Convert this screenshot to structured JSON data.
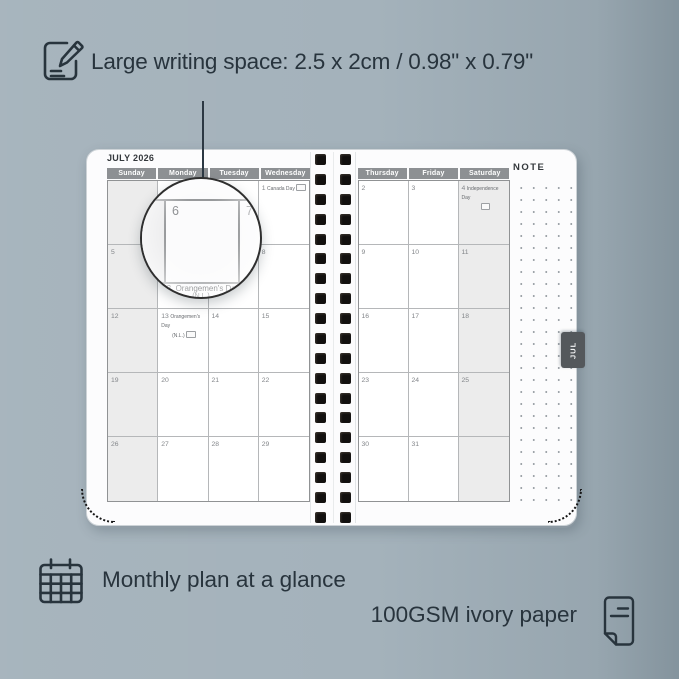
{
  "colors": {
    "background": "#a4b2bb",
    "ink": "#28343d",
    "page_white": "#fcfcfd",
    "header_gray": "#8d9093",
    "weekend_gray": "#ececec",
    "tab_gray": "#54585c",
    "spiral_black": "#12100f"
  },
  "annotations": {
    "writing_space": {
      "icon": "pencil-note-icon",
      "text": "Large writing space: 2.5 x 2cm / 0.98\" x 0.79\""
    },
    "monthly_plan": {
      "icon": "calendar-grid-icon",
      "text": "Monthly plan at a glance"
    },
    "paper": {
      "icon": "paper-sheet-icon",
      "text": "100GSM ivory paper"
    }
  },
  "planner": {
    "month_title": "JULY 2026",
    "note_label": "NOTE",
    "month_tab": "JUL",
    "left_page": {
      "day_headers": [
        "Sunday",
        "Monday",
        "Tuesday",
        "Wednesday"
      ],
      "weeks": [
        [
          {},
          {},
          {},
          {
            "day": "1",
            "holiday": "Canada Day",
            "flag": "inline"
          }
        ],
        [
          {
            "day": "5"
          },
          {
            "day": "6"
          },
          {
            "day": "7"
          },
          {
            "day": "8"
          }
        ],
        [
          {
            "day": "12"
          },
          {
            "day": "13",
            "holiday": "Orangemen's Day",
            "line2": "(N.L.)",
            "flag": "below"
          },
          {
            "day": "14"
          },
          {
            "day": "15"
          }
        ],
        [
          {
            "day": "19"
          },
          {
            "day": "20"
          },
          {
            "day": "21"
          },
          {
            "day": "22"
          }
        ],
        [
          {
            "day": "26"
          },
          {
            "day": "27"
          },
          {
            "day": "28"
          },
          {
            "day": "29"
          }
        ]
      ]
    },
    "right_page": {
      "day_headers": [
        "Thursday",
        "Friday",
        "Saturday"
      ],
      "weeks": [
        [
          {
            "day": "2"
          },
          {
            "day": "3"
          },
          {
            "day": "4",
            "holiday": "Independence Day",
            "flag": "below"
          }
        ],
        [
          {
            "day": "9"
          },
          {
            "day": "10"
          },
          {
            "day": "11"
          }
        ],
        [
          {
            "day": "16"
          },
          {
            "day": "17"
          },
          {
            "day": "18"
          }
        ],
        [
          {
            "day": "23"
          },
          {
            "day": "24"
          },
          {
            "day": "25"
          }
        ],
        [
          {
            "day": "30"
          },
          {
            "day": "31"
          },
          {}
        ]
      ]
    },
    "magnifier": {
      "day_left": "6",
      "day_right": "7",
      "caption_day": "13",
      "caption_holiday": "Orangemen's Day",
      "caption_region": "(N.L.)"
    }
  }
}
